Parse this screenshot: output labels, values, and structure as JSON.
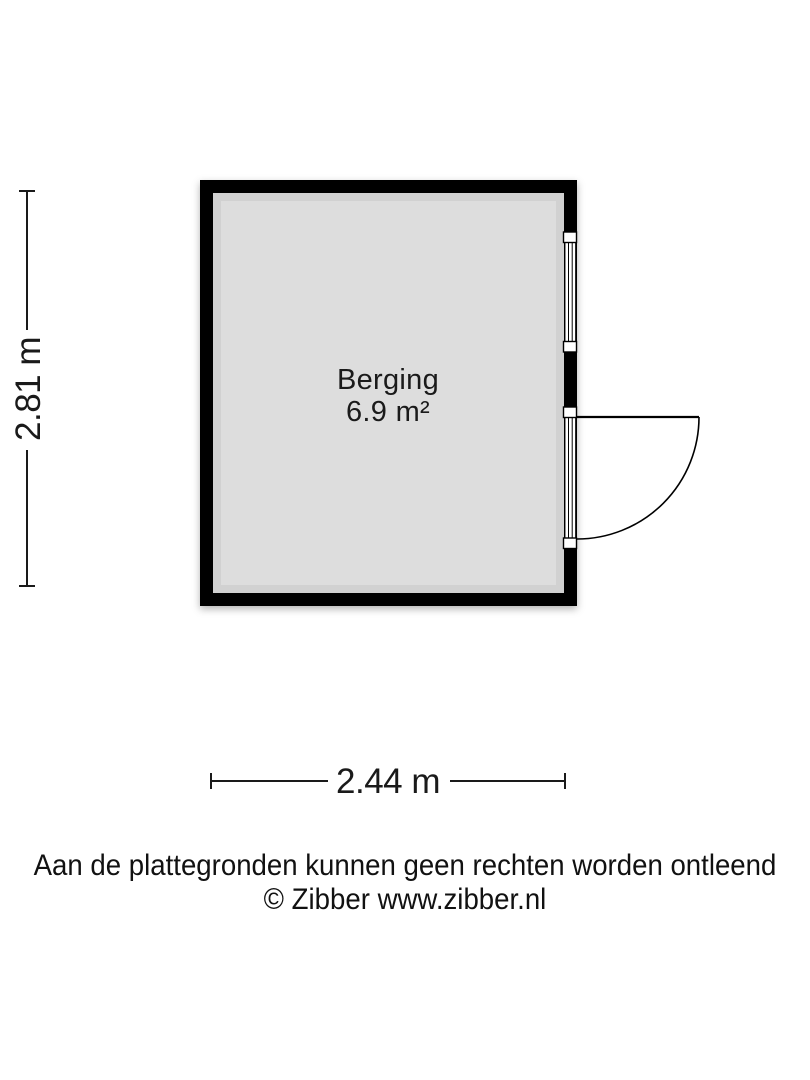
{
  "floor_plan": {
    "room": {
      "name": "Berging",
      "area_label": "6.9 m²"
    },
    "dimensions": {
      "height_label": "2.81 m",
      "width_label": "2.44 m"
    },
    "features": [
      {
        "type": "window",
        "wall": "right"
      },
      {
        "type": "door",
        "wall": "right",
        "swing": "outward-right"
      }
    ],
    "colors": {
      "wall": "#000000",
      "floor": "#dddddd",
      "background": "#ffffff",
      "line": "#1a1a1a"
    }
  },
  "footer": {
    "disclaimer": "Aan de plattegronden kunnen geen rechten worden ontleend",
    "credit": "© Zibber www.zibber.nl"
  }
}
